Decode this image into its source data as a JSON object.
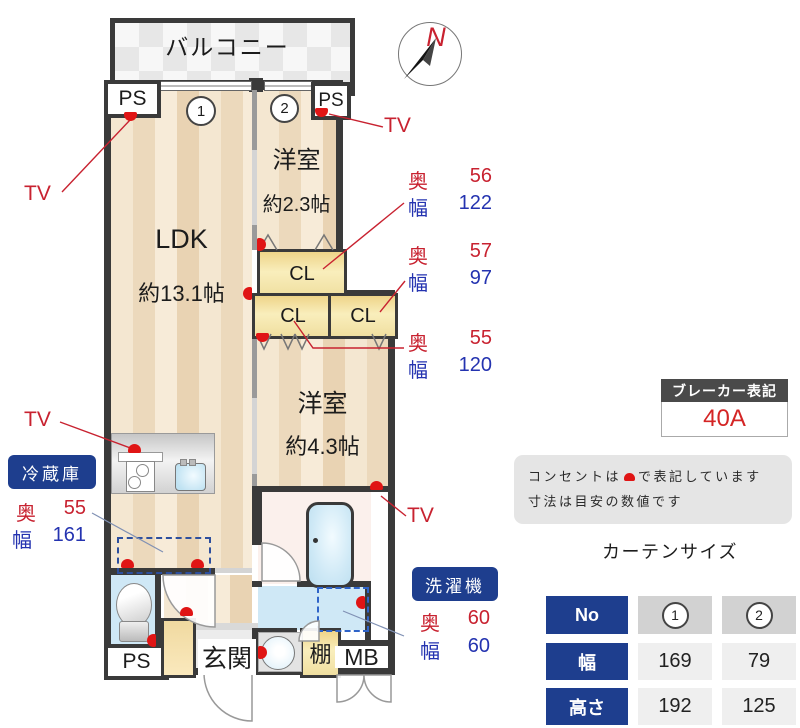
{
  "plan": {
    "balcony": "バルコニー",
    "ps": "PS",
    "window_1": "1",
    "window_2": "2",
    "ldk_name": "LDK",
    "ldk_size": "約13.1帖",
    "bedroom1_name": "洋室",
    "bedroom1_size": "約2.3帖",
    "bedroom2_name": "洋室",
    "bedroom2_size": "約4.3帖",
    "closet": "CL",
    "entrance": "玄関",
    "shelf": "棚",
    "meter_box": "MB",
    "compass_north": "N"
  },
  "annotations": {
    "tv": "TV",
    "depth_label": "奥",
    "width_label": "幅",
    "closet1": {
      "depth": "56",
      "width": "122"
    },
    "closet2": {
      "depth": "57",
      "width": "97"
    },
    "closet3": {
      "depth": "55",
      "width": "120"
    },
    "fridge_label": "冷蔵庫",
    "fridge": {
      "depth": "55",
      "width": "161"
    },
    "washer_label": "洗濯機",
    "washer": {
      "depth": "60",
      "width": "60"
    }
  },
  "breaker": {
    "title": "ブレーカー表記",
    "value": "40A"
  },
  "note": {
    "line1_pre": "コンセントは",
    "line1_post": "で表記しています",
    "line2": "寸法は目安の数値です"
  },
  "curtain_table": {
    "title": "カーテンサイズ",
    "no_label": "No",
    "col1": "1",
    "col2": "2",
    "rows": [
      {
        "label": "幅",
        "v1": "169",
        "v2": "79"
      },
      {
        "label": "高さ",
        "v1": "192",
        "v2": "125"
      }
    ]
  },
  "colors": {
    "accent_red": "#c82230",
    "accent_blue": "#2433b0",
    "navy": "#1e3e8e",
    "wall": "#3a3a3a"
  }
}
